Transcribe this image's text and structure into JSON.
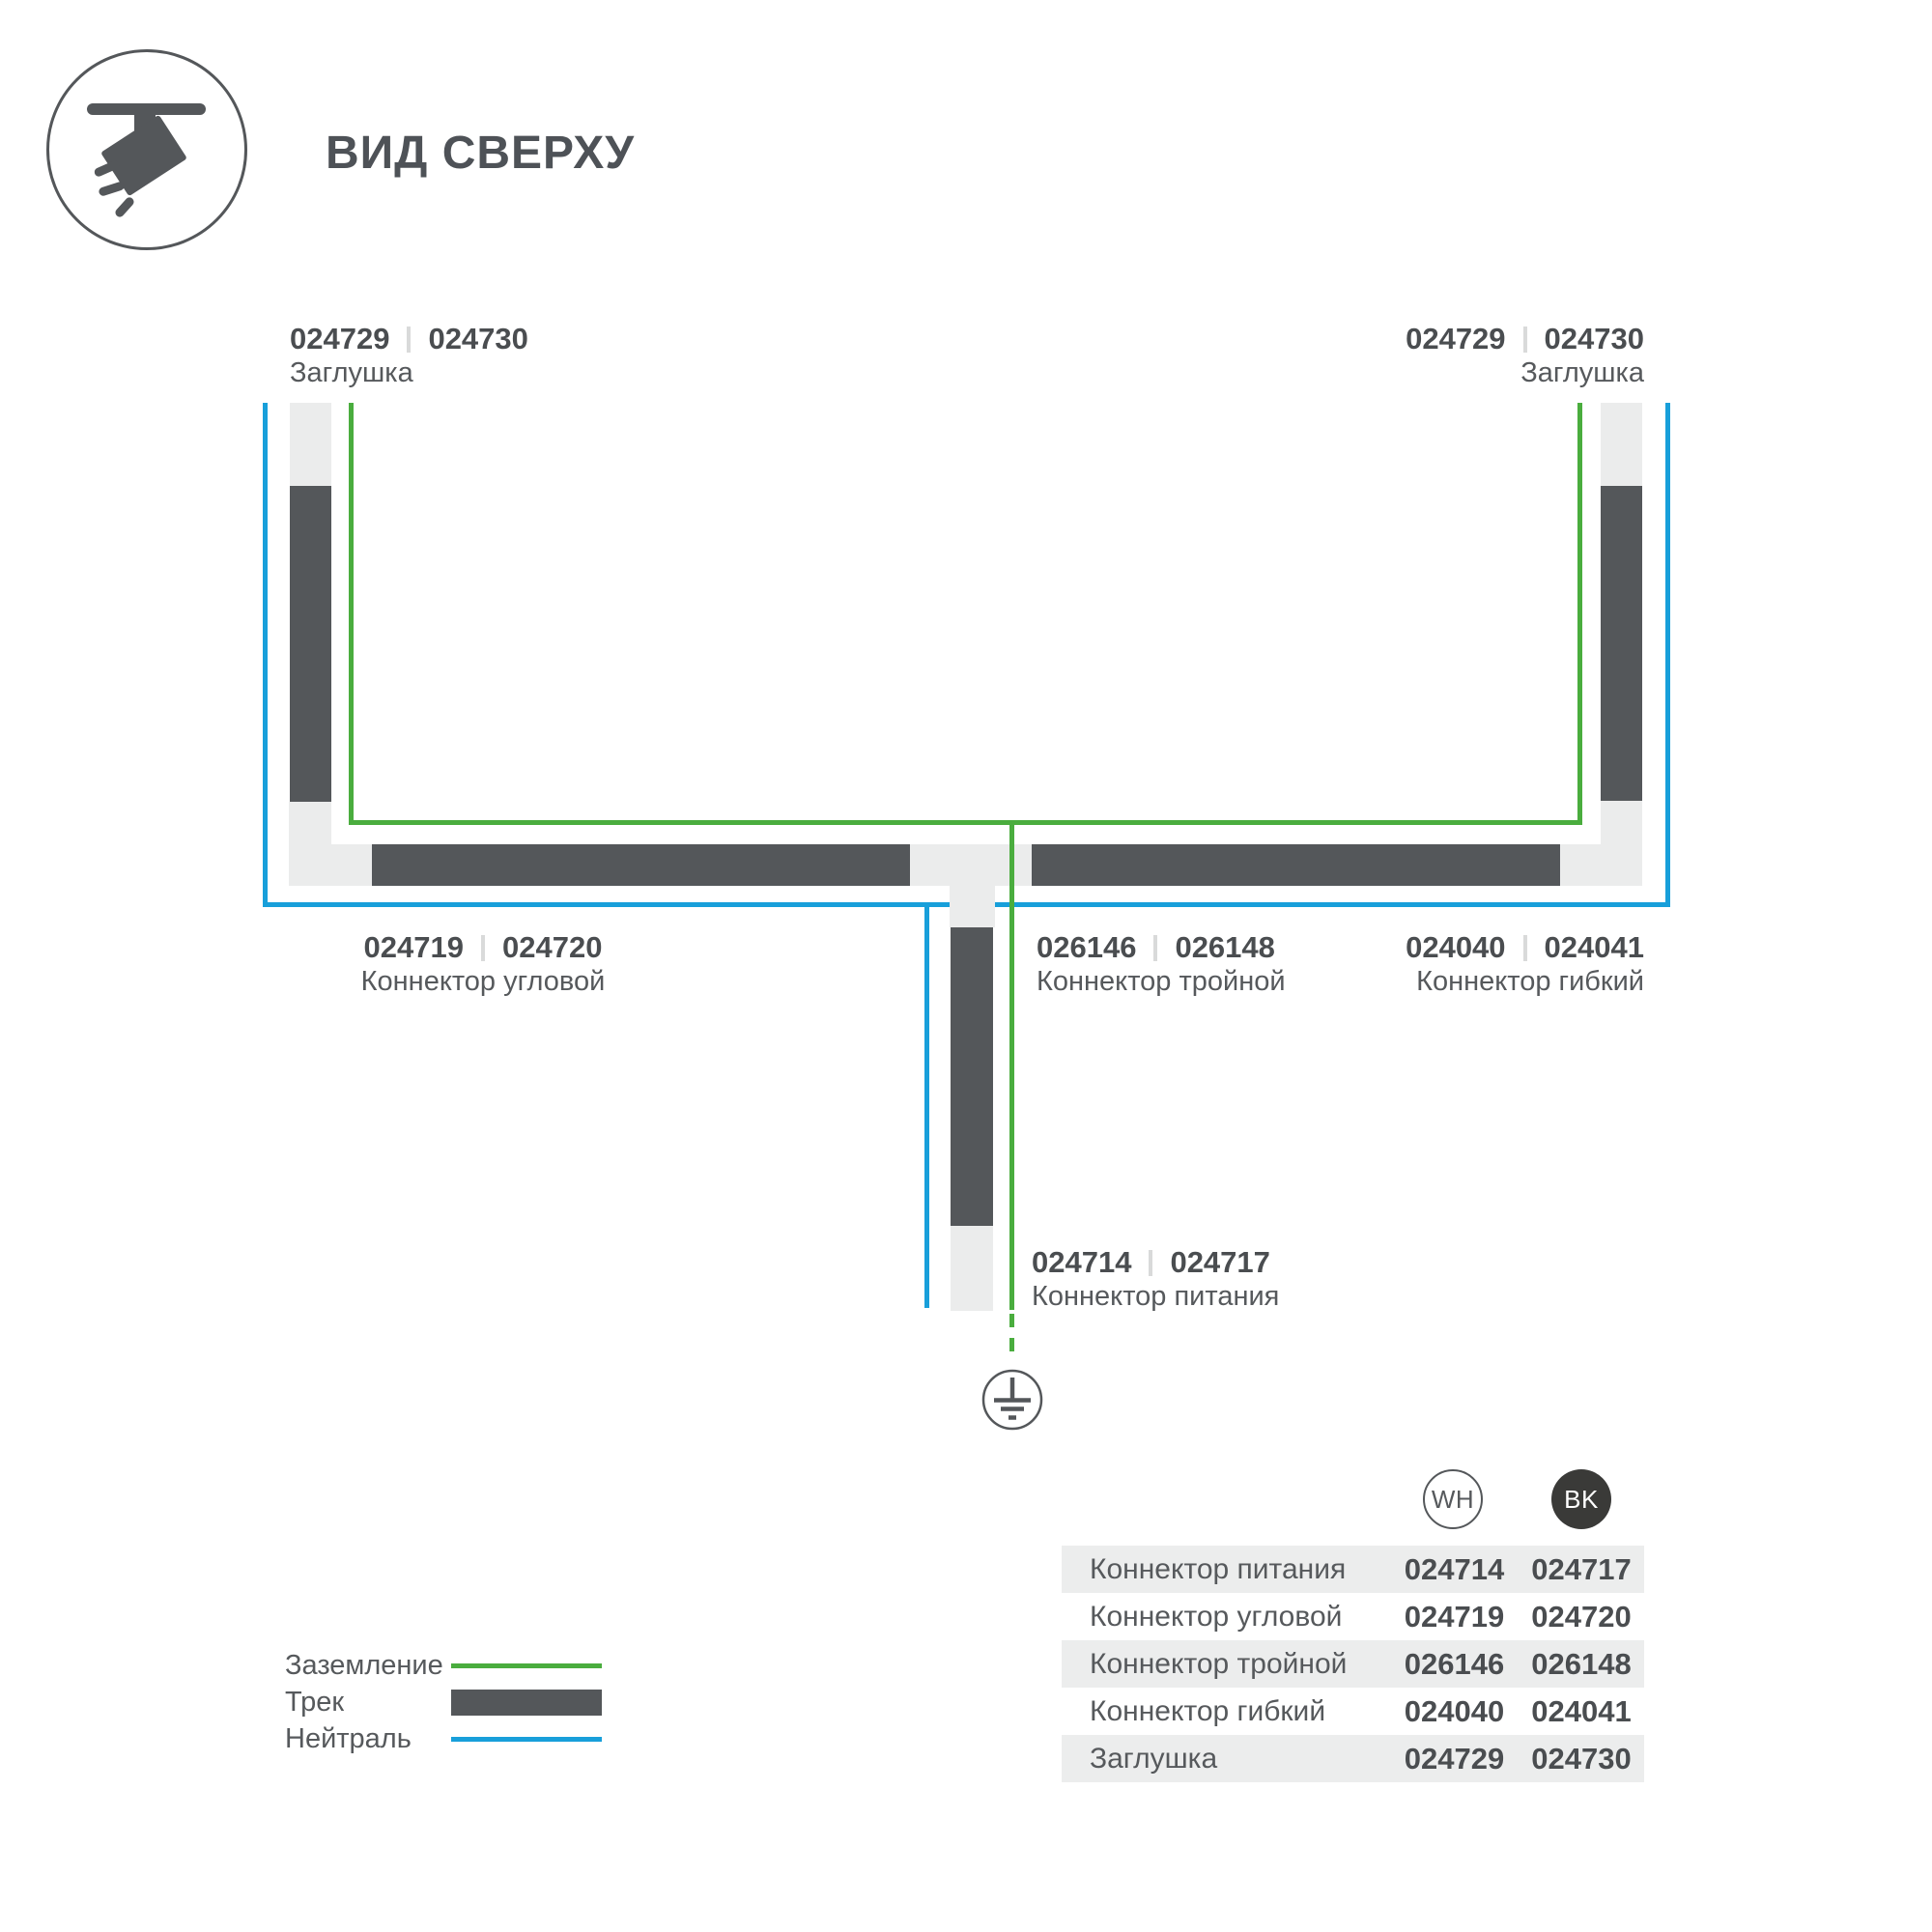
{
  "header": {
    "title": "ВИД СВЕРХУ",
    "icon": "track-spotlight-icon"
  },
  "colors": {
    "track": "#54575A",
    "connector": "#EBECEC",
    "ground_green": "#4AAD3E",
    "neutral_blue": "#189FDA",
    "text": "#56595C",
    "text_dark": "#4A4D50",
    "separator": "#D9DADA",
    "row_gray": "#ECEDED",
    "bk_fill": "#3A3A38"
  },
  "diagram": {
    "labels": {
      "endcap_left": {
        "code_wh": "024729",
        "code_bk": "024730",
        "name": "Заглушка"
      },
      "endcap_right": {
        "code_wh": "024729",
        "code_bk": "024730",
        "name": "Заглушка"
      },
      "corner": {
        "code_wh": "024719",
        "code_bk": "024720",
        "name": "Коннектор угловой"
      },
      "triple": {
        "code_wh": "026146",
        "code_bk": "026148",
        "name": "Коннектор тройной"
      },
      "flex": {
        "code_wh": "024040",
        "code_bk": "024041",
        "name": "Коннектор гибкий"
      },
      "power": {
        "code_wh": "024714",
        "code_bk": "024717",
        "name": "Коннектор питания"
      }
    },
    "ground_icon": "earth-ground-symbol"
  },
  "legend": {
    "items": [
      {
        "label": "Заземление",
        "swatch": "green-line"
      },
      {
        "label": "Трек",
        "swatch": "track-bar"
      },
      {
        "label": "Нейтраль",
        "swatch": "blue-line"
      }
    ]
  },
  "table": {
    "columns": [
      {
        "id": "WH",
        "label": "WH"
      },
      {
        "id": "BK",
        "label": "BK"
      }
    ],
    "rows": [
      {
        "label": "Коннектор питания",
        "wh": "024714",
        "bk": "024717"
      },
      {
        "label": "Коннектор угловой",
        "wh": "024719",
        "bk": "024720"
      },
      {
        "label": "Коннектор тройной",
        "wh": "026146",
        "bk": "026148"
      },
      {
        "label": "Коннектор гибкий",
        "wh": "024040",
        "bk": "024041"
      },
      {
        "label": "Заглушка",
        "wh": "024729",
        "bk": "024730"
      }
    ]
  }
}
